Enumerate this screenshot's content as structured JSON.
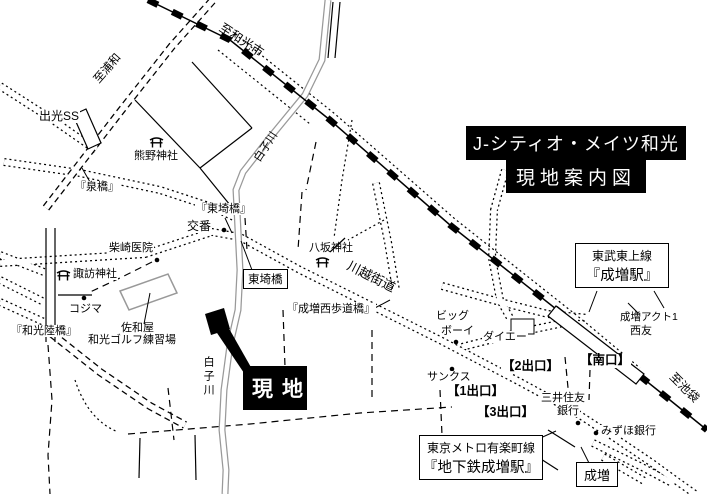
{
  "colors": {
    "ink": "#000000",
    "river": "#999999",
    "background": "#ffffff",
    "site_box_bg": "#000000",
    "site_box_text": "#ffffff"
  },
  "title": {
    "line1": "J-シティオ・メイツ和光",
    "line2": "現地案内図"
  },
  "site": {
    "label": "現地"
  },
  "railway": {
    "dest_west": "至和光市",
    "dest_east": "至池袋"
  },
  "river": {
    "name": "白子川",
    "name_vertical": "白子川"
  },
  "roads": {
    "kawagoe_kaido": "川越街道",
    "dest_urawa": "至浦和"
  },
  "stations": {
    "tobu_line": "東武東上線",
    "tobu_name": "『成増駅』",
    "metro_line": "東京メトロ有楽町線",
    "metro_name": "『地下鉄成増駅』",
    "narimasu": "成増",
    "south_exit": "【南口】",
    "exit1": "【1出口】",
    "exit2": "【2出口】",
    "exit3": "【3出口】"
  },
  "bridges": {
    "izumi": "『泉橋』",
    "higashisaki": "『東埼橋』",
    "higashisaki_box": "東埼橋",
    "wako_overpass": "『和光陸橋』",
    "narimasu_nishi": "『成増西歩道橋』"
  },
  "pois": {
    "idemitsu": "出光SS",
    "kumano_shrine": "熊野神社",
    "koban": "交番",
    "shibasaki_clinic": "柴崎医院",
    "suwa_shrine": "諏訪神社",
    "kojima": "コジマ",
    "sawaya": "佐和屋",
    "wako_golf": "和光ゴルフ練習場",
    "yasaka_shrine": "八坂神社",
    "big_boy_line1": "ビッグ",
    "big_boy_line2": "ボーイ",
    "daiei": "ダイエー",
    "sunkus": "サンクス",
    "smbc_line1": "三井住友",
    "smbc_line2": "銀行",
    "mizuho": "みずほ銀行",
    "act1": "成増アクト1",
    "seiyu": "西友"
  }
}
